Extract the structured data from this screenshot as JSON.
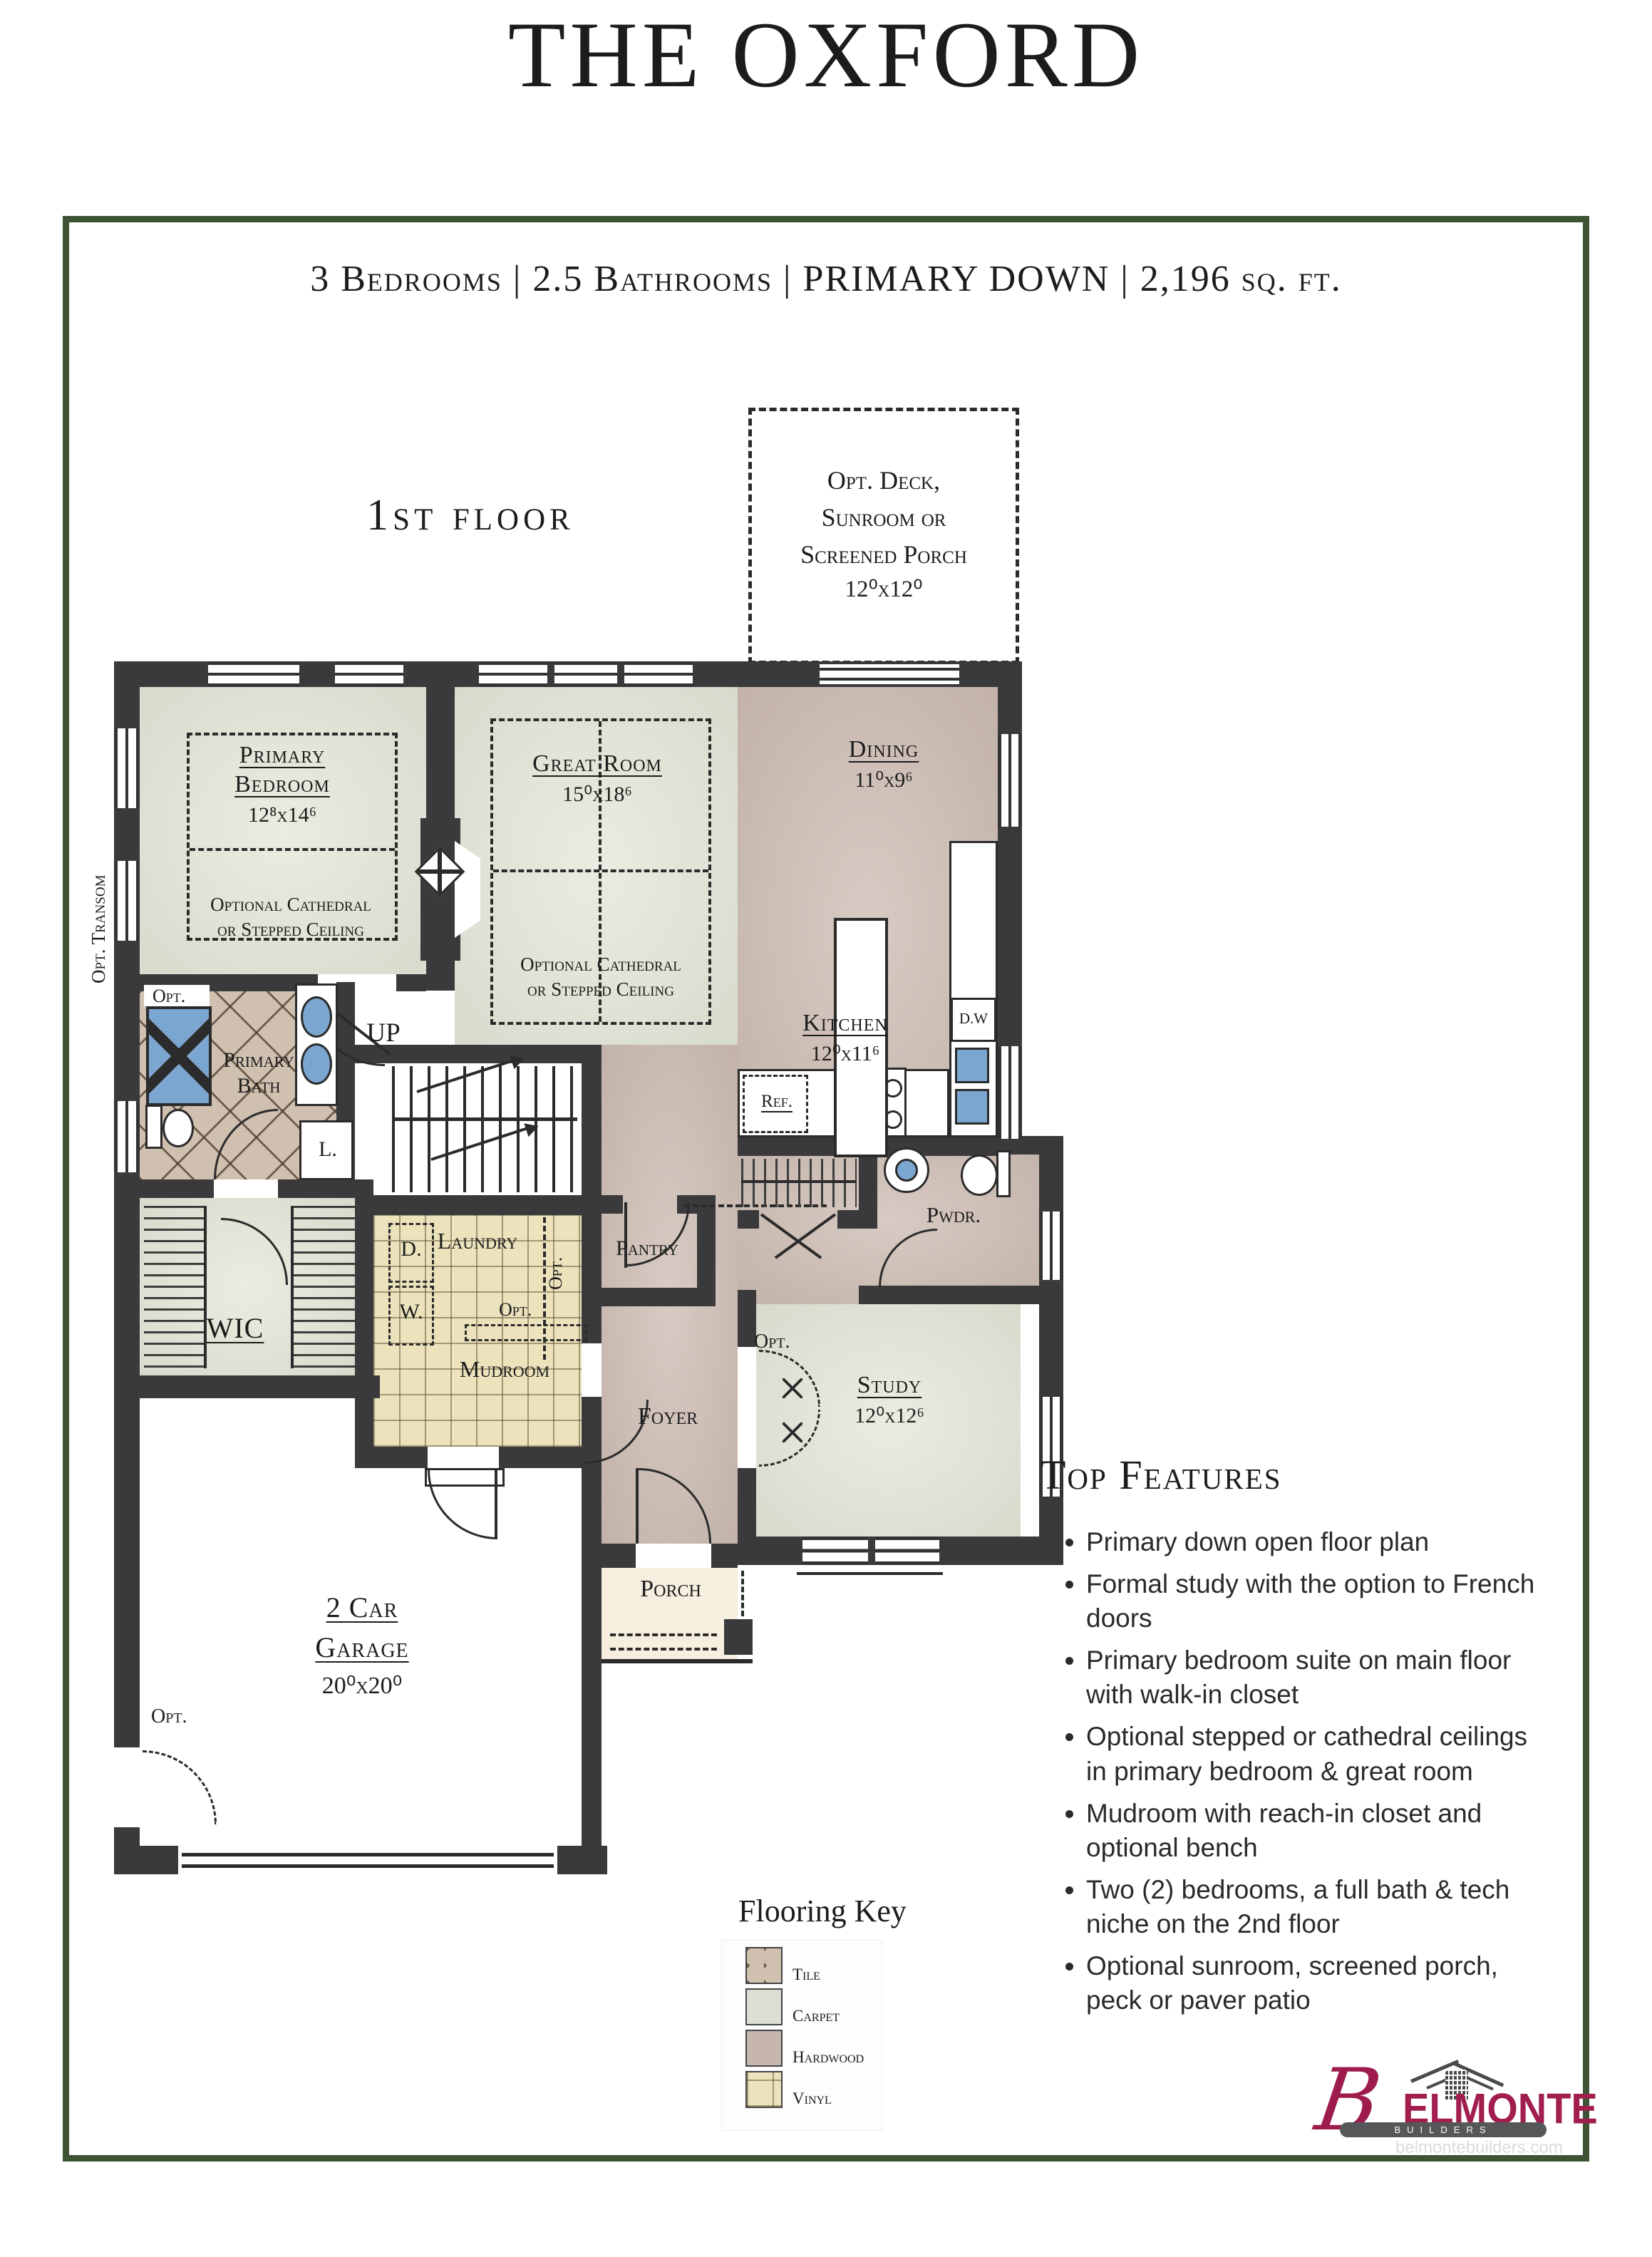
{
  "title": "THE OXFORD",
  "subtitle": "3 Bedrooms | 2.5 Bathrooms | PRIMARY DOWN | 2,196 sq. ft.",
  "floor_label": "1st floor",
  "opt_deck": {
    "line1": "Opt. Deck,",
    "line2": "Sunroom or",
    "line3": "Screened Porch",
    "dims": "12⁰x12⁰"
  },
  "rooms": {
    "primary_bedroom": {
      "name1": "Primary",
      "name2": "Bedroom",
      "dims": "12⁸x14⁶"
    },
    "great_room": {
      "name": "Great Room",
      "dims": "15⁰x18⁶"
    },
    "dining": {
      "name": "Dining",
      "dims": "11⁰x9⁶"
    },
    "kitchen": {
      "name": "Kitchen",
      "dims": "12⁰x11⁶"
    },
    "study": {
      "name": "Study",
      "dims": "12⁰x12⁶"
    },
    "garage": {
      "name1": "2 Car",
      "name2": "Garage",
      "dims": "20⁰x20⁰"
    },
    "primary_bath": {
      "name1": "Primary",
      "name2": "Bath"
    },
    "wic": "WIC",
    "laundry": "Laundry",
    "mudroom": "Mudroom",
    "pantry": "Pantry",
    "foyer": "Foyer",
    "porch": "Porch",
    "powder": "Pwdr."
  },
  "ceiling_note": {
    "line1": "Optional Cathedral",
    "line2": "or Stepped Ceiling"
  },
  "labels": {
    "up": "UP",
    "ref": "Ref.",
    "dw": "D.W",
    "dryer": "D.",
    "washer": "W.",
    "linen": "L.",
    "opt": "Opt.",
    "opt_transom": "Opt. Transom"
  },
  "features": {
    "heading": "Top Features",
    "items": [
      "Primary down open floor plan",
      "Formal study with the option to French doors",
      "Primary bedroom suite on main floor with walk-in closet",
      "Optional stepped or cathedral ceilings in primary bedroom & great room",
      "Mudroom with reach-in closet and optional bench",
      "Two (2) bedrooms, a full bath & tech niche on the 2nd floor",
      "Optional sunroom, screened porch, peck or paver patio"
    ]
  },
  "flooring_key": {
    "title": "Flooring Key",
    "items": [
      {
        "label": "Tile"
      },
      {
        "label": "Carpet"
      },
      {
        "label": "Hardwood"
      },
      {
        "label": "Vinyl"
      }
    ]
  },
  "logo": {
    "brand_b": "B",
    "brand_rest": "ELMONTE",
    "builders": "BUILDERS",
    "website": "belmontebuilders.com"
  },
  "colors": {
    "border_green": "#3c5334",
    "wall": "#3a3a3c",
    "carpet": "#dcdfd2",
    "hardwood": "#c8b8af",
    "tile": "#cfc0b0",
    "vinyl": "#ece3bd",
    "porch": "#f6efdf",
    "fixture_blue": "#7ba6d0",
    "logo_crimson": "#a11e4e",
    "logo_gray": "#565759"
  }
}
